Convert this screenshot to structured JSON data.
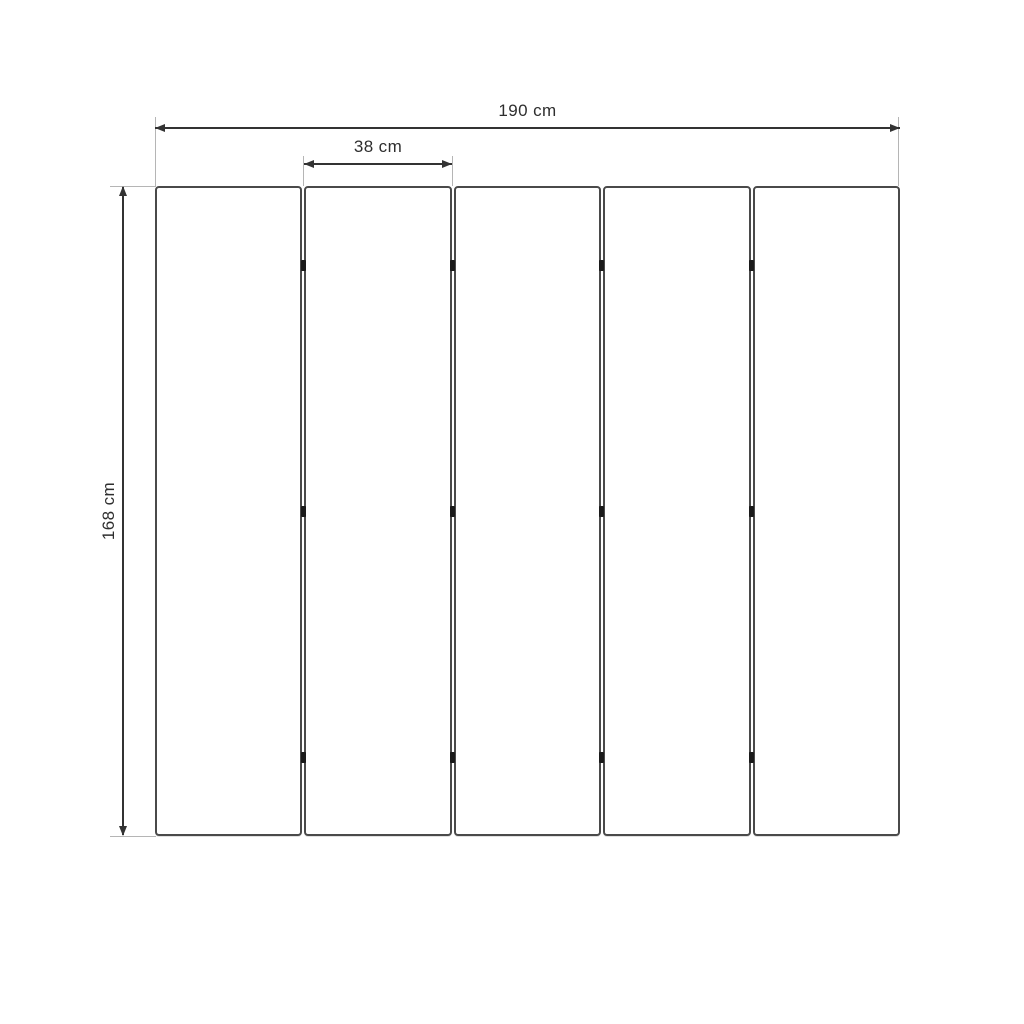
{
  "diagram": {
    "type": "dimension-drawing",
    "panel_count": 5,
    "hinge_rows_per_gap": 3,
    "labels": {
      "total_width": "190 cm",
      "panel_width": "38 cm",
      "height": "168 cm"
    },
    "values_cm": {
      "total_width": 190,
      "panel_width": 38,
      "height": 168
    },
    "colors": {
      "background": "#ffffff",
      "panel_border": "#4a4a4a",
      "dimension_line": "#333333",
      "extension_line": "#b5b5b5",
      "hinge": "#1a1a1a",
      "text": "#2e2e2e"
    }
  }
}
